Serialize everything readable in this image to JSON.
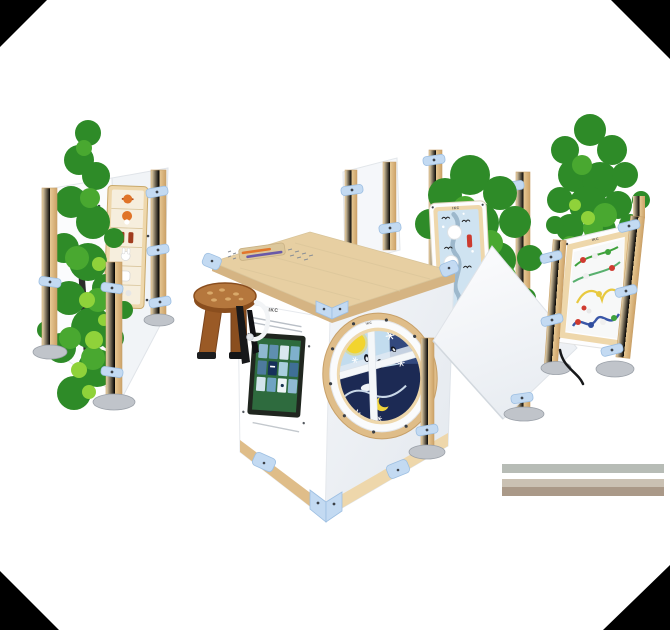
{
  "brand": {
    "logo_text": "IKC"
  },
  "colors": {
    "panel_white": "#ffffff",
    "panel_shade": "#eef1f5",
    "panel_shade_dark": "#e0e5eb",
    "wood_light": "#eed7ab",
    "wood_mid": "#dfbd89",
    "wood_dark": "#c7a069",
    "plywood_top": "#e7cfa2",
    "plywood_edge": "#d5b483",
    "clamp_blue": "#c3daf2",
    "clamp_blue_dark": "#9dbfe2",
    "tree_green_dark": "#2e8b28",
    "tree_green_mid": "#49a830",
    "tree_green_light": "#8fd23a",
    "screen_frame": "#20261f",
    "screen_bg": "#2e6b3e",
    "porthole_day": "#c2dcee",
    "porthole_night": "#1c2a54",
    "sun_yellow": "#f2d42e",
    "maze_blue": "#cfe3f1",
    "stool_brown": "#a8641f",
    "stool_top": "#b5773d",
    "metal_foot": "#c0c4ca",
    "floor_gray": "#b7bcb6",
    "floor_beige": "#cac1b3",
    "floor_taupe": "#aa9988",
    "corner_black": "#000000",
    "wire_green": "#3fa23c",
    "wire_yellow": "#e8c93f",
    "wire_blue": "#3a57a8",
    "bead_red": "#cf3b30"
  },
  "screen": {
    "tiles": [
      "#8fb8d0",
      "#5f8fb0",
      "#d8e7ee",
      "#7fb0cc",
      "#4d7a9e",
      "#16305a",
      "#a9cede",
      "#3f6f96",
      "#d3e4ec",
      "#6fa3c2",
      "#eef4f7",
      "#8fb9d2"
    ]
  },
  "modules": {
    "left": "animal-sorting-panel",
    "front": "touchscreen-games-module",
    "side": "seasons-porthole-wheel",
    "back": "winter-birds-maze-panel",
    "right": "wire-bead-maze-panel",
    "seat": "mushroom-stool",
    "decor": "tree-graphic-panels"
  }
}
